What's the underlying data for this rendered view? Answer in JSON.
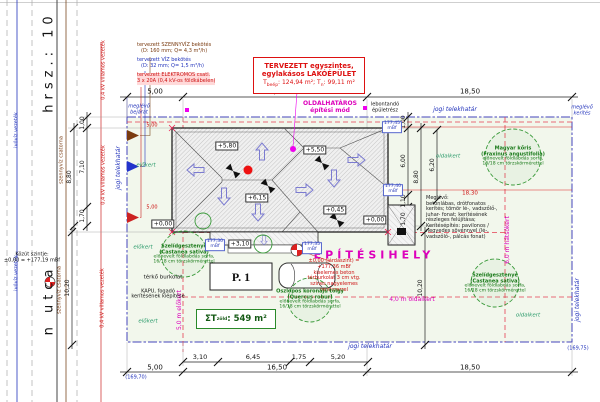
{
  "colors": {
    "boundary_blue": "#4444bb",
    "setback_red": "#e53e51",
    "magenta": "#dd00bb",
    "tree_green": "#3a9a3a",
    "roof_outline": "#222222",
    "plot_tint": "#f2f7ec"
  },
  "street": {
    "hrsz": "hrsz.: 10",
    "name": "n utca",
    "sewer": "szennyvíz csatorna",
    "power": "0,4 kV villamos vezeték",
    "water": "ivóvíz vezeték",
    "road_level_1": "Közút szintje:",
    "road_level_2": "±0,00 = +177,19 mBf"
  },
  "utilities": {
    "sewer1": "tervezett SZENNYVÍZ bekötés",
    "sewer2": "(D: 160 mm; Q= 4,3 m³/h)",
    "water1": "tervezett VÍZ bekötés",
    "water2": "(D: 32 mm; Q= 1,5 m³/h)",
    "elec1": "tervezett ELEKTROMOS csatl.",
    "elec2": "3 x 20A (0,4 kV-os földkábelen)"
  },
  "building_box": {
    "line1": "TERVEZETT egyszintes,",
    "line2": "egylakásos LAKÓÉPÜLET",
    "t1": "T",
    "t1sub": "beép",
    "mid": ": 124,94 m²;  T",
    "t2sub": "n",
    "end": ": 99,11 m²"
  },
  "site": {
    "mode1": "OLDALHATÁROS",
    "mode2": "építési mód",
    "demolish1": "lebontandó",
    "demolish2": "épületrész",
    "legal_boundary": "jogi telekhatár",
    "front_yard": "előkert",
    "side_yard": "oldalkert",
    "side_setback": "4,0 m oldalkert",
    "rear_setback": "6,0 m hátsókert",
    "front_setback": "5,0 m előkert",
    "building_site": "ÉPÍTÉSIHELY",
    "entry1": "meglévő",
    "entry2": "bejárat",
    "fence1": "meglévő",
    "fence2": "kerítés",
    "corner_left": "(169,70)",
    "corner_right": "(169,75)"
  },
  "elevations": {
    "e580": "+5,80",
    "e550": "+5,50",
    "e615": "+6,15",
    "e045": "+0,45",
    "e000": "+0,00",
    "e310": "+3,10"
  },
  "spot_heights": {
    "s1": "177,45",
    "s2": "177,40",
    "s3": "177,30",
    "s4": "177,35",
    "unit": "mBf"
  },
  "note_red": {
    "l1": "±0,00 (járdaszint) = +177,36 mBf",
    "l2": "kiselemes beton térburkolat 3 cm vtg.",
    "l3": "színes nagyelemes rendszerrel"
  },
  "note_block": {
    "lines": [
      "Meglévő:",
      "betonlábas, drótfonatos",
      "kerítés; tömör lé-, vadszőlő-,",
      "juhar- fonat; kerítésének",
      "részleges felújítása;",
      "Kerítésépítés: pavilonos /",
      "negyedes sövénnyel (lé-,",
      "vadszőlő-, pálcás fonat)"
    ]
  },
  "parking": {
    "label": "P. 1"
  },
  "green_area": {
    "prefix": "ΣT",
    "sub": "zöld",
    "value": ": 549 m²"
  },
  "paving": {
    "label": "térkő burkolat",
    "gate1": "KAPU, fogadó",
    "gate2": "kerítésének kiépítése"
  },
  "trees": {
    "t1name": "Szelídgesztenye",
    "t1latin": "(Castanea sativa)",
    "t2name": "Oszlopos koronájú tölgy",
    "t2latin": "(Quercus robur)",
    "t3name": "Magyar kőris",
    "t3latin": "(Fraxinus angustifolia)",
    "note1": "előnevelt földlabdás sorfa,",
    "note2": "16/18 cm törzskörmérettel"
  },
  "dims": {
    "d500": "5,00",
    "d1650": "16,50",
    "d1850": "18,50",
    "d310": "3,10",
    "d645": "6,45",
    "d175": "1,75",
    "d520": "5,20",
    "d100": "1,00",
    "d710": "7,10",
    "d880": "8,80",
    "d170": "1,70",
    "d1020": "10,20",
    "d600": "6,00",
    "d110": "1,10",
    "d620": "6,20",
    "d1830": "18,30"
  }
}
